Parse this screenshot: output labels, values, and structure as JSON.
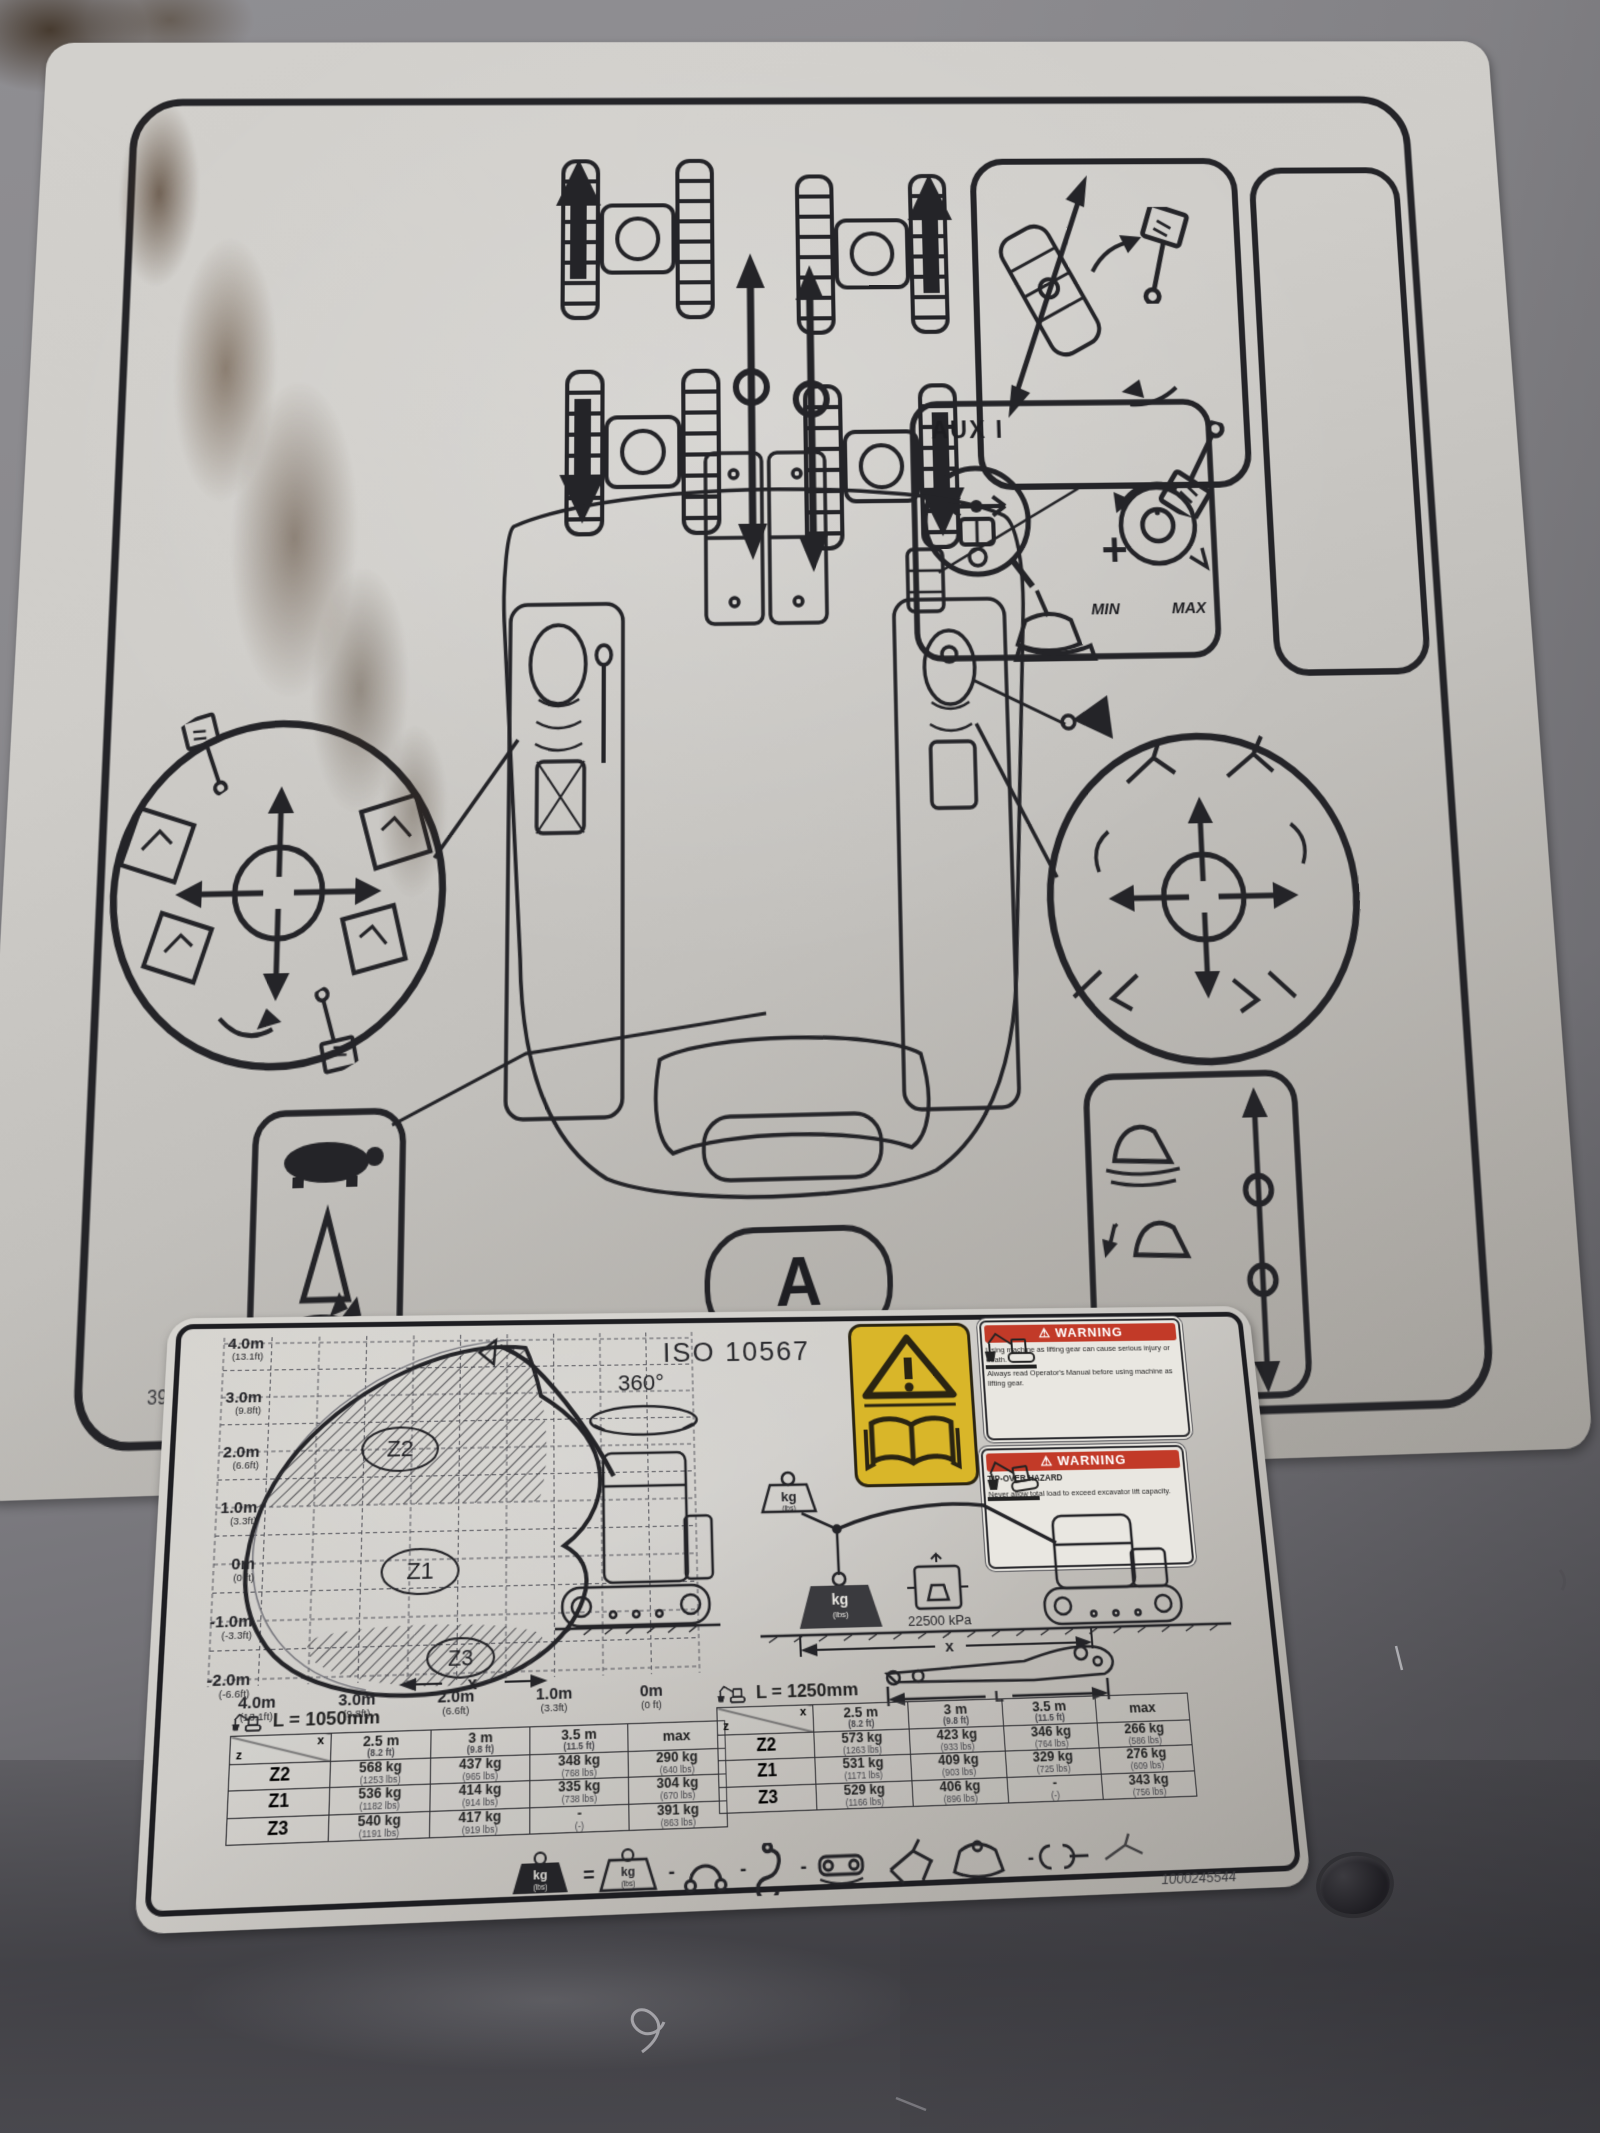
{
  "top_decal": {
    "aux_label": "AUX I",
    "min_label": "MIN",
    "max_label": "MAX",
    "pattern_letter": "A",
    "title_line1": "OPERATING",
    "title_line2": "PATTERN",
    "part_number_left": "395-3501",
    "part_number_right": "1000279080"
  },
  "bottom_decal": {
    "iso_title": "ISO 10567",
    "swing_label": "360°",
    "pressure_label": "22500 kPa",
    "dim_x": "x",
    "dim_l": "L",
    "weight": {
      "kg": "kg",
      "lbs": "(lbs)"
    },
    "ops": {
      "eq": "=",
      "minus": "-",
      "plus": "+"
    },
    "warning_glyph": "⚠",
    "warning1": {
      "header": "WARNING",
      "line1": "Using machine as lifting gear can cause serious injury or death.",
      "line2": "Always read Operator's Manual before using machine as lifting gear."
    },
    "warning2": {
      "header": "WARNING",
      "hazard": "TIP-OVER HAZARD",
      "line1": "Never allow total load to exceed excavator lift capacity."
    },
    "part_number": "1000245544",
    "chart": {
      "zones": [
        "Z2",
        "Z1",
        "Z3"
      ],
      "y_ticks": [
        {
          "m": "4.0m",
          "ft": "(13.1ft)"
        },
        {
          "m": "3.0m",
          "ft": "(9.8ft)"
        },
        {
          "m": "2.0m",
          "ft": "(6.6ft)"
        },
        {
          "m": "1.0m",
          "ft": "(3.3ft)"
        },
        {
          "m": "0m",
          "ft": "(0 ft)"
        },
        {
          "m": "-1.0m",
          "ft": "(-3.3ft)"
        },
        {
          "m": "-2.0m",
          "ft": "(-6.6ft)"
        }
      ],
      "x_ticks": [
        {
          "m": "4.0m",
          "ft": "(13.1ft)"
        },
        {
          "m": "3.0m",
          "ft": "(9.8ft)"
        },
        {
          "m": "2.0m",
          "ft": "(6.6ft)"
        },
        {
          "m": "1.0m",
          "ft": "(3.3ft)"
        },
        {
          "m": "0m",
          "ft": "(0 ft)"
        }
      ]
    },
    "table_header": {
      "corner_z": "z",
      "corner_x": "x",
      "cols": [
        {
          "m": "2.5 m",
          "ft": "(8.2 ft)"
        },
        {
          "m": "3 m",
          "ft": "(9.8 ft)"
        },
        {
          "m": "3.5 m",
          "ft": "(11.5 ft)"
        },
        {
          "m": "max",
          "ft": ""
        }
      ]
    },
    "tables": [
      {
        "title": "L = 1050mm",
        "rows": [
          {
            "zone": "Z2",
            "cells": [
              {
                "kg": "568 kg",
                "lbs": "(1253 lbs)"
              },
              {
                "kg": "437 kg",
                "lbs": "(965 lbs)"
              },
              {
                "kg": "348 kg",
                "lbs": "(768 lbs)"
              },
              {
                "kg": "290 kg",
                "lbs": "(640 lbs)"
              }
            ]
          },
          {
            "zone": "Z1",
            "cells": [
              {
                "kg": "536 kg",
                "lbs": "(1182 lbs)"
              },
              {
                "kg": "414 kg",
                "lbs": "(914 lbs)"
              },
              {
                "kg": "335 kg",
                "lbs": "(738 lbs)"
              },
              {
                "kg": "304 kg",
                "lbs": "(670 lbs)"
              }
            ]
          },
          {
            "zone": "Z3",
            "cells": [
              {
                "kg": "540 kg",
                "lbs": "(1191 lbs)"
              },
              {
                "kg": "417 kg",
                "lbs": "(919 lbs)"
              },
              {
                "kg": "-",
                "lbs": "(-)"
              },
              {
                "kg": "391 kg",
                "lbs": "(863 lbs)"
              }
            ]
          }
        ]
      },
      {
        "title": "L = 1250mm",
        "rows": [
          {
            "zone": "Z2",
            "cells": [
              {
                "kg": "573 kg",
                "lbs": "(1263 lbs)"
              },
              {
                "kg": "423 kg",
                "lbs": "(933 lbs)"
              },
              {
                "kg": "346 kg",
                "lbs": "(764 lbs)"
              },
              {
                "kg": "266 kg",
                "lbs": "(586 lbs)"
              }
            ]
          },
          {
            "zone": "Z1",
            "cells": [
              {
                "kg": "531 kg",
                "lbs": "(1171 lbs)"
              },
              {
                "kg": "409 kg",
                "lbs": "(903 lbs)"
              },
              {
                "kg": "329 kg",
                "lbs": "(725 lbs)"
              },
              {
                "kg": "276 kg",
                "lbs": "(609 lbs)"
              }
            ]
          },
          {
            "zone": "Z3",
            "cells": [
              {
                "kg": "529 kg",
                "lbs": "(1166 lbs)"
              },
              {
                "kg": "406 kg",
                "lbs": "(896 lbs)"
              },
              {
                "kg": "-",
                "lbs": "(-)"
              },
              {
                "kg": "343 kg",
                "lbs": "(756 lbs)"
              }
            ]
          }
        ]
      }
    ]
  },
  "colors": {
    "panel_grey": "#86858a",
    "decal_white": "#cfcdc9",
    "ink": "#242428",
    "warning_red": "#c23a28",
    "caution_yellow": "#d9b629"
  }
}
